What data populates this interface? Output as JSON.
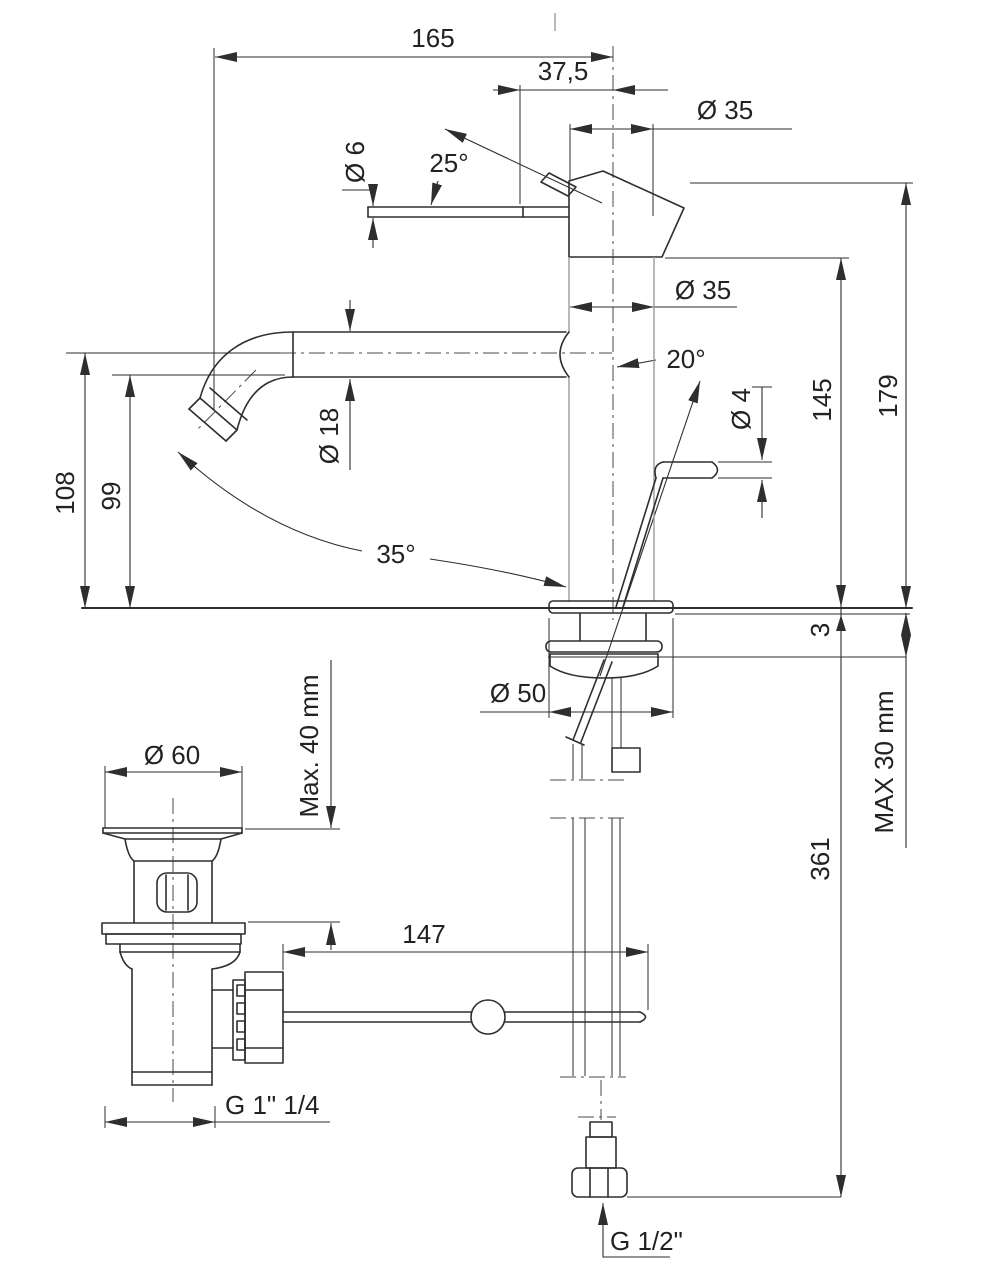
{
  "drawing": {
    "type": "technical-dimension-drawing",
    "subject": "Single-lever basin mixer faucet with pop-up waste drain, side elevation",
    "units": "mm",
    "line_color": "#2e2e2e",
    "background_color": "#ffffff",
    "dimensions": {
      "spout_reach": "165",
      "handle_offset": "37,5",
      "top_diameter": "Ø 35",
      "body_diameter": "Ø 35",
      "lever_diameter": "Ø 6",
      "handle_angle": "25°",
      "spout_tube_diameter": "Ø 18",
      "rod_angle": "20°",
      "rod_diameter": "Ø 4",
      "height_to_body_top": "145",
      "height_overall": "179",
      "spout_height_max": "108",
      "spout_height": "99",
      "swivel_angle": "35°",
      "base_plate_thickness": "3",
      "base_diameter": "Ø 50",
      "deck_thickness_max": "MAX 30 mm",
      "drain_flange_diameter": "Ø 60",
      "drain_deck_max": "Max. 40 mm",
      "height_below_deck": "361",
      "rod_to_drain_distance": "147",
      "drain_thread": "G 1\" 1/4",
      "supply_thread": "G 1/2\""
    }
  }
}
